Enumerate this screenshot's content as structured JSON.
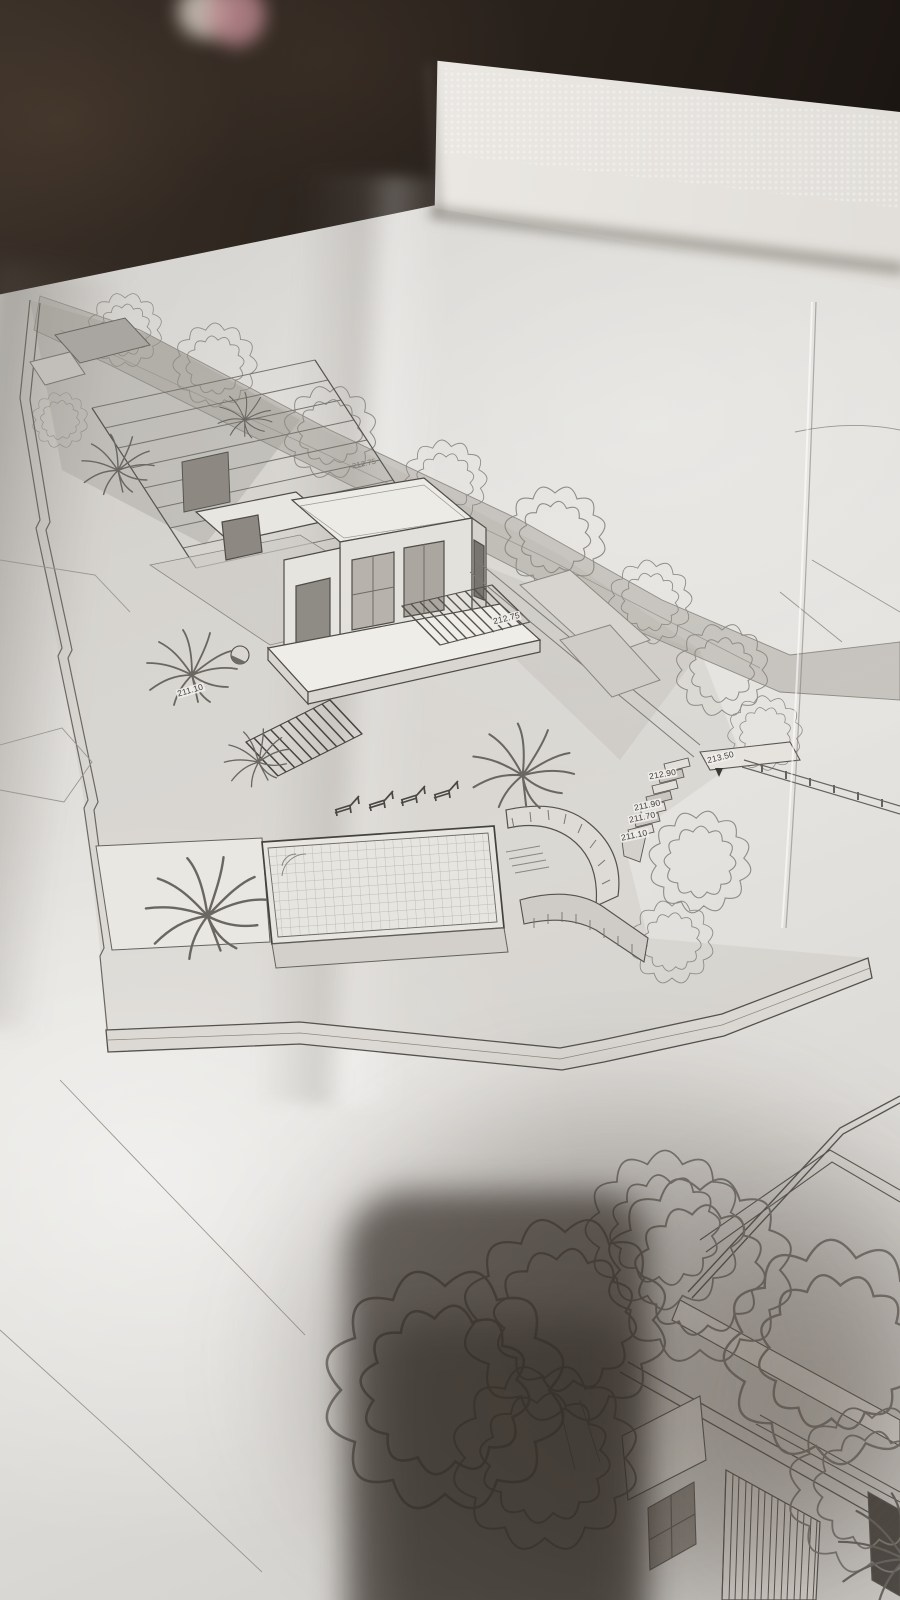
{
  "photo": {
    "subject": "architectural axonometric site drawings on folded paper sheets photographed on a dark table",
    "palette": {
      "table": "#231c17",
      "paper": "#dcdad6",
      "folder_sheet": "#eceae6",
      "drawing_line": "#57544f",
      "phone_shadow": "#3f3833",
      "background_object_pink": "#c08b92"
    }
  },
  "drawing": {
    "elevation_labels": [
      {
        "text": "213.50",
        "x": 706,
        "y": 753,
        "rot": -14
      },
      {
        "text": "212.90",
        "x": 648,
        "y": 770,
        "rot": -10
      },
      {
        "text": "211.90",
        "x": 633,
        "y": 801,
        "rot": -12
      },
      {
        "text": "211.70",
        "x": 628,
        "y": 813,
        "rot": -12
      },
      {
        "text": "211.10",
        "x": 620,
        "y": 831,
        "rot": -12
      },
      {
        "text": "212.75",
        "x": 492,
        "y": 614,
        "rot": -14
      },
      {
        "text": "212.75",
        "x": 351,
        "y": 459,
        "rot": -12,
        "faint": true
      },
      {
        "text": "211.10",
        "x": 176,
        "y": 686,
        "rot": -16
      }
    ]
  }
}
